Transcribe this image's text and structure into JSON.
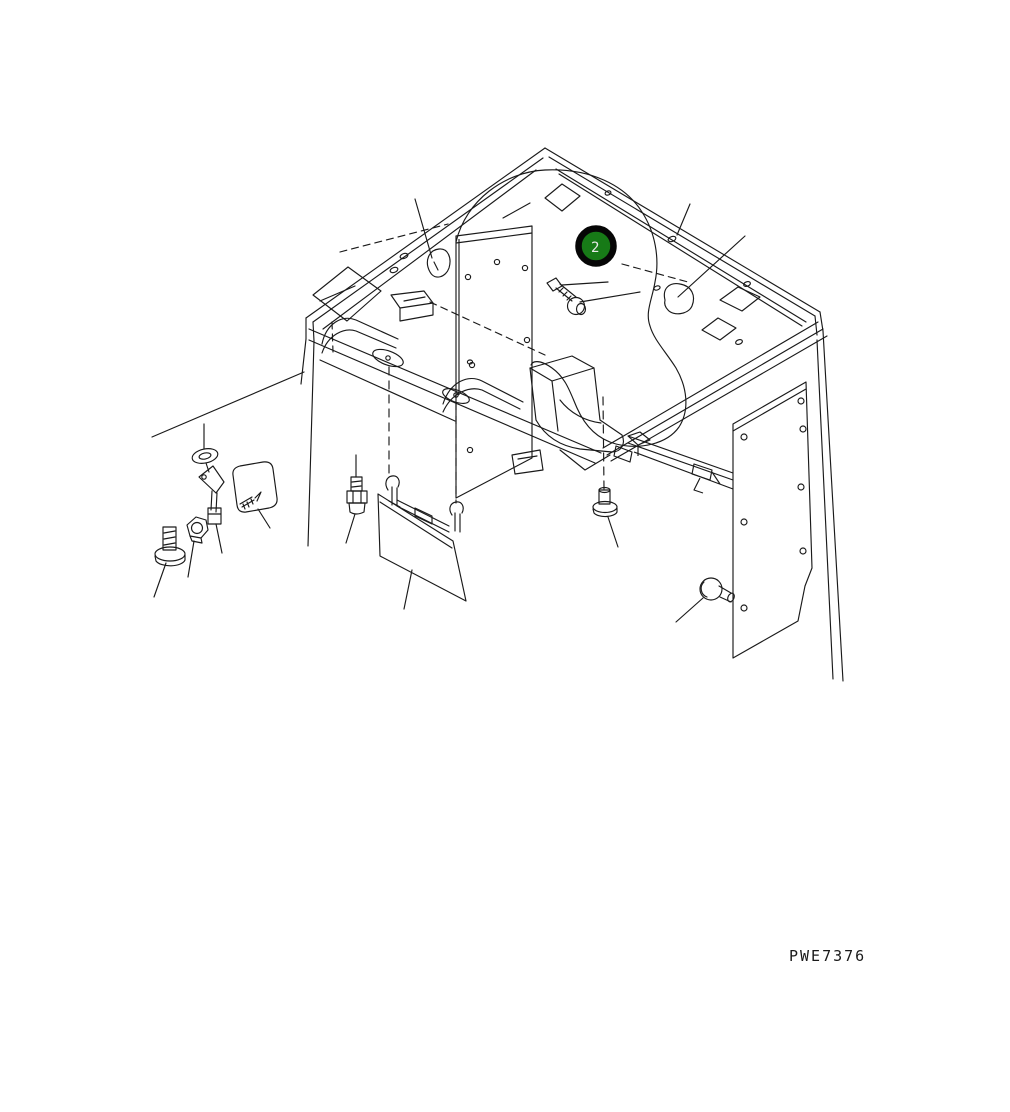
{
  "diagram": {
    "drawing_code": "PWE7376",
    "balloon": {
      "label": "2",
      "fill": "#177a17",
      "ring_color": "#060606",
      "text_color": "#e9e9e9"
    },
    "background_color": "#ffffff",
    "line_color": "#1a1a1a"
  }
}
